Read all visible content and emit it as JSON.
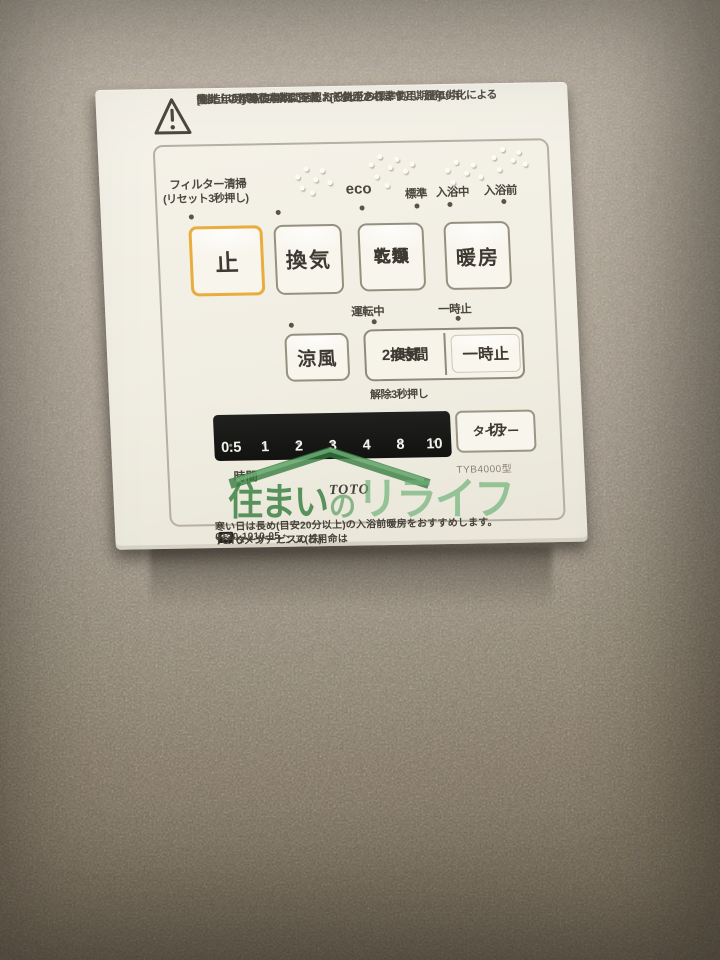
{
  "panel": {
    "warning": {
      "icon": "warning-triangle-icon",
      "line1": "[製造年月] 製品本体に記載　[設計上の標準使用期間]10年",
      "line2": "設計上の標準使用期間を超えて使用されますと、経年劣化による",
      "line3": "発火・けが等の事故に至るおそれがあります。"
    },
    "indicator_labels": {
      "filter_clean": "フィルター清掃",
      "filter_reset_note": "(リセット3秒押し)",
      "eco": "eco",
      "standard": "標準",
      "bathing": "入浴中",
      "pre_bathing": "入浴前",
      "running": "運転中",
      "paused": "一時止",
      "release_note": "解除3秒押し"
    },
    "buttons": {
      "stop": "止",
      "ventilation": "換気",
      "clothes_drying": [
        "衣類",
        "乾燥"
      ],
      "heating": "暖房",
      "cool_breeze": "涼風",
      "vent_24h": [
        "24時間",
        "換気"
      ],
      "temp_stop": "一時止",
      "timer_off": [
        "切",
        "タイマー"
      ]
    },
    "timer": {
      "values": [
        "0.5",
        "1",
        "2",
        "3",
        "4",
        "8",
        "10"
      ],
      "unit": "時間"
    },
    "model": "TYB4000型",
    "brand": "TOTO",
    "footer": {
      "line1": "寒い日は長め(目安20分以上)の入浴前暖房をおすすめします。",
      "service_prefix": "アフターサービスのご用命は",
      "phone_icon": "telephone-icon",
      "phone_glyph": "☎",
      "phone": "0120-1010-05",
      "service_company": "TOTOメンテナンス(株)"
    },
    "colors": {
      "stop_active_border": "#e9ad3e",
      "panel_bg": "#f1eee3",
      "timer_bar": "#151514",
      "watermark_green": "#4f9a5f"
    }
  },
  "watermark": {
    "part1": "住まい",
    "part2": "の",
    "part3": "リライフ"
  }
}
